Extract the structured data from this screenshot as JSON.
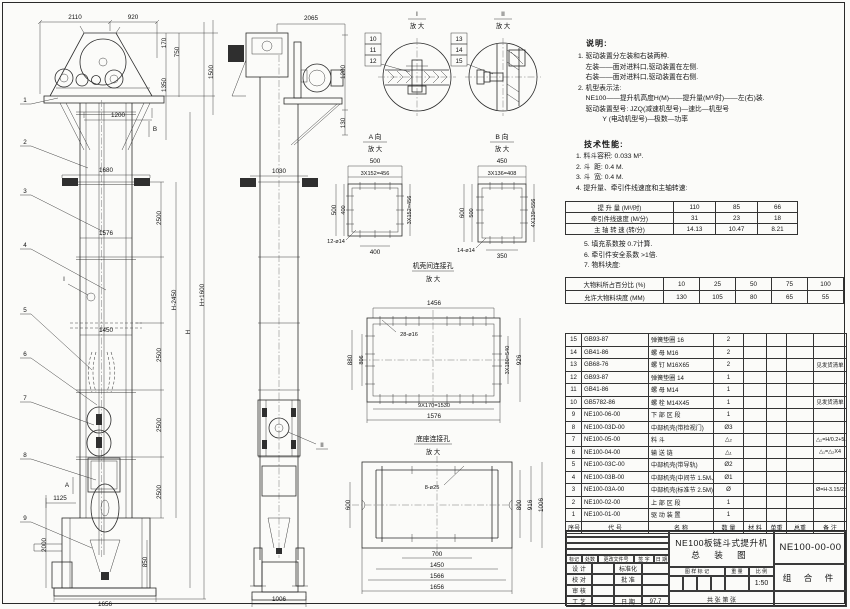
{
  "notes": {
    "title": "说明:",
    "lines": [
      {
        "t": "1. 驱动装置分左装和右装两种."
      },
      {
        "t": "    左装——面对进料口,驱动装置在左侧."
      },
      {
        "t": "    右装——面对进料口,驱动装置在右侧."
      },
      {
        "t": "2. 机型表示法:"
      },
      {
        "t": "    NE100——提升机高度H(M)——提升量(M³/时)——左(右)装."
      },
      {
        "t": "    驱动装置型号: JZQ(减速机型号)—速比—机型号"
      },
      {
        "t": "             Y (电动机型号)—极数—功率"
      }
    ]
  },
  "tech": {
    "title": "技术性能:",
    "items": [
      {
        "t": "1. 料斗容积: 0.033 M³."
      },
      {
        "t": "2. 斗  距: 0.4 M."
      },
      {
        "t": "3. 斗  宽: 0.4 M."
      },
      {
        "t": "4. 提升量、牵引件线速度和主轴转速:"
      }
    ],
    "items2": [
      {
        "t": "5. 填充系数按 0.7计算."
      },
      {
        "t": "6. 牵引件安全系数 >1倍."
      },
      {
        "t": "7. 物料块度:"
      }
    ]
  },
  "speed_table": {
    "rows": [
      {
        "l": "提 升 量  (M³/时)",
        "a": "110",
        "b": "85",
        "c": "66"
      },
      {
        "l": "牵引件线速度 (M/分)",
        "a": "31",
        "b": "23",
        "c": "18"
      },
      {
        "l": "主 轴 转 速 (转/分)",
        "a": "14.13",
        "b": "10.47",
        "c": "8.21"
      }
    ]
  },
  "lump_table": {
    "rows": [
      {
        "l": "大物料所占百分比 (%)",
        "a": "10",
        "b": "25",
        "c": "50",
        "d": "75",
        "e": "100"
      },
      {
        "l": "允许大物料块度 (MM)",
        "a": "130",
        "b": "105",
        "c": "80",
        "d": "65",
        "e": "55"
      }
    ]
  },
  "parts": {
    "headers": {
      "no": "序号",
      "code": "代  号",
      "name": "名    称",
      "qty": "数 量",
      "mat": "材  料",
      "w1": "单重",
      "w2": "总重",
      "note": "备 注"
    },
    "rows": [
      {
        "no": "15",
        "code": "GB93-87",
        "name": "弹簧垫圈  16",
        "qty": "2",
        "mat": "",
        "w1": "",
        "w2": "",
        "note": ""
      },
      {
        "no": "14",
        "code": "GB41-86",
        "name": "螺 母  M16",
        "qty": "2",
        "mat": "",
        "w1": "",
        "w2": "",
        "note": ""
      },
      {
        "no": "13",
        "code": "GB68-76",
        "name": "螺 钉  M16X65",
        "qty": "2",
        "mat": "",
        "w1": "",
        "w2": "",
        "note": "见发货清单"
      },
      {
        "no": "12",
        "code": "GB93-87",
        "name": "弹簧垫圈  14",
        "qty": "1",
        "mat": "",
        "w1": "",
        "w2": "",
        "note": ""
      },
      {
        "no": "11",
        "code": "GB41-86",
        "name": "螺 母  M14",
        "qty": "1",
        "mat": "",
        "w1": "",
        "w2": "",
        "note": ""
      },
      {
        "no": "10",
        "code": "GB5782-86",
        "name": "螺 栓  M14X45",
        "qty": "1",
        "mat": "",
        "w1": "",
        "w2": "",
        "note": "见发货清单"
      },
      {
        "no": "9",
        "code": "NE100-06-00",
        "name": "下 部 区 段",
        "qty": "1",
        "mat": "",
        "w1": "",
        "w2": "",
        "note": ""
      },
      {
        "no": "8",
        "code": "NE100-03D-00",
        "name": "中部机壳(带检视门)",
        "qty": "Ø3",
        "mat": "",
        "w1": "",
        "w2": "",
        "note": ""
      },
      {
        "no": "7",
        "code": "NE100-05-00",
        "name": "料  斗",
        "qty": "△₂",
        "mat": "",
        "w1": "",
        "w2": "",
        "note": "△₂=H/0.2+5.75"
      },
      {
        "no": "6",
        "code": "NE100-04-00",
        "name": "输 送 链",
        "qty": "△₁",
        "mat": "",
        "w1": "",
        "w2": "",
        "note": "△₁=△₂X4"
      },
      {
        "no": "5",
        "code": "NE100-03C-00",
        "name": "中部机壳(带导轨)",
        "qty": "Ø2",
        "mat": "",
        "w1": "",
        "w2": "",
        "note": ""
      },
      {
        "no": "4",
        "code": "NE100-03B-00",
        "name": "中部机壳(中间节 1.5M、1M)",
        "qty": "Ø1",
        "mat": "",
        "w1": "",
        "w2": "",
        "note": ""
      },
      {
        "no": "3",
        "code": "NE100-03A-00",
        "name": "中部机壳(标准节 2.5M)",
        "qty": "Ø",
        "mat": "",
        "w1": "",
        "w2": "",
        "note": "Ø=H-3.15/2.5"
      },
      {
        "no": "2",
        "code": "NE100-02-00",
        "name": "上 部 区 段",
        "qty": "1",
        "mat": "",
        "w1": "",
        "w2": "",
        "note": ""
      },
      {
        "no": "1",
        "code": "NE100-01-00",
        "name": "驱 动 装 置",
        "qty": "1",
        "mat": "",
        "w1": "",
        "w2": "",
        "note": ""
      }
    ]
  },
  "title_block": {
    "product": "NE100板链斗式提升机",
    "sheet_name": "总 装 图",
    "drawing_no": "NE100-00-00",
    "type": "组 合 件",
    "rev_headers": [
      "标记",
      "处数",
      "更改文件号",
      "签 字",
      "日 期"
    ],
    "sig1": "设 计",
    "sig2": "校 对",
    "sig3": "审 核",
    "sig4": "工 艺",
    "sigb1": "标准化",
    "sigb2": "批 准",
    "sigb3": "",
    "sigb4": "日 期",
    "date": "97.7",
    "stamp1": "图 样 标 记",
    "stamp2": "重 量",
    "stamp3": "比 例",
    "scale": "1:50",
    "sheet_info": "共  张  第  张"
  },
  "dims": {
    "fv_2110": "2110",
    "fv_920": "920",
    "fv_170": "170",
    "fv_750": "750",
    "fv_1350": "1350",
    "fv_1500": "1500",
    "fv_1200": "1200",
    "fv_1680": "1680",
    "fv_1576": "1576",
    "fv_1450": "1450",
    "fv_1125": "1125",
    "fv_2500": "2500",
    "fv_2000": "2000",
    "fv_850": "850",
    "fv_1656": "1656",
    "fv_H1600": "H+1600",
    "fv_H2450": "H-2450",
    "fv_H": "H",
    "sv_2065": "2065",
    "sv_1200": "1200",
    "sv_130": "130",
    "sv_1030": "1030",
    "sv_1006": "1006"
  },
  "leaders": {
    "n1": "1",
    "n2": "2",
    "n3": "3",
    "n4": "4",
    "n5": "5",
    "n6": "6",
    "n7": "7",
    "n8": "8",
    "n9": "9",
    "n10": "10",
    "n11": "11",
    "n12": "12",
    "n13": "13",
    "n14": "14",
    "n15": "15",
    "mA": "A",
    "mB": "B",
    "mI": "I",
    "mII": "II"
  },
  "det": {
    "i_t": "I",
    "ii_t": "II",
    "mag": "放 大",
    "a_t": "A 向",
    "b_t": "B 向",
    "shell_t": "机壳间连接孔",
    "base_t": "底座连接孔",
    "a_500t": "500",
    "a_3x152": "3X152=456",
    "a_500l": "500",
    "a_400l": "400",
    "a_3x152r": "3X152=456",
    "a_400b": "400",
    "a_12d14": "12-ø14",
    "b_450": "450",
    "b_3x136": "3X136=408",
    "b_600": "600",
    "b_500": "500",
    "b_4x139": "4X139=556",
    "b_14d14": "14-ø14",
    "b_350": "350",
    "s_1456": "1456",
    "s_28d16": "28-ø16",
    "s_880": "880",
    "s_806": "806",
    "s_3x180": "3X180=540",
    "s_926": "926",
    "s_9x170": "9X170=1530",
    "s_1576": "1576",
    "bs_8d25": "8-ø25",
    "bs_600": "600",
    "bs_800": "800",
    "bs_916": "916",
    "bs_1006": "1006",
    "bs_700": "700",
    "bs_1450": "1450",
    "bs_1566": "1566",
    "bs_1656": "1656"
  }
}
